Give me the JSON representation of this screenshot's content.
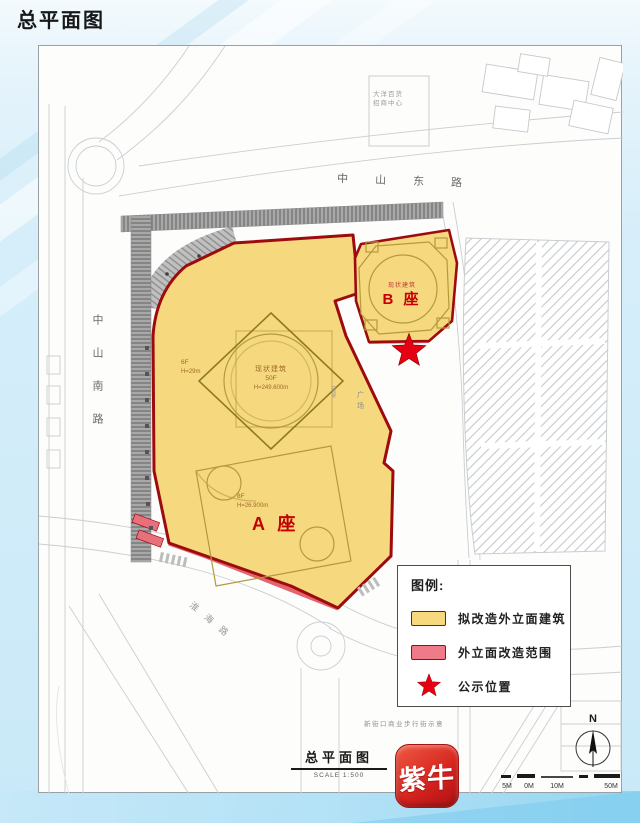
{
  "page_title": "总平面图",
  "map": {
    "roads": {
      "east": "中山东路",
      "south": "中山南路",
      "southwest": "淮海路"
    },
    "labels": {
      "building_a": "A 座",
      "building_a_floors": "8F",
      "building_a_height": "H=26.900m",
      "tower_name": "现状建筑",
      "tower_floors": "50F",
      "tower_height": "H=249.600m",
      "annex_floors": "6F",
      "annex_height": "H=29m",
      "building_b": "B 座",
      "building_b_note": "现状建筑",
      "north_block_line1": "大洋百货",
      "north_block_line2": "招商中心",
      "plaza": "广场",
      "dimension": "4660",
      "caption": "新街口商业步行街示意"
    }
  },
  "legend": {
    "title": "图例:",
    "items": [
      {
        "label": "拟改造外立面建筑",
        "swatch": "yellow-fill"
      },
      {
        "label": "外立面改造范围",
        "swatch": "red-fill"
      },
      {
        "label": "公示位置",
        "swatch": "red-star"
      }
    ]
  },
  "footer": {
    "drawing_title": "总平面图",
    "scale_text": "SCALE 1:500",
    "logo_text": "紫牛",
    "north_label": "N",
    "scalebar_labels": [
      "5M",
      "0M",
      "10M",
      "50M"
    ]
  },
  "colors": {
    "parcel_fill": "#F6D97E",
    "parcel_border": "#9E0B0F",
    "legend_red": "#EE7B87",
    "star_red": "#E60012",
    "logo_red": "#D0191E",
    "background_blue": "#CFEAF8"
  }
}
